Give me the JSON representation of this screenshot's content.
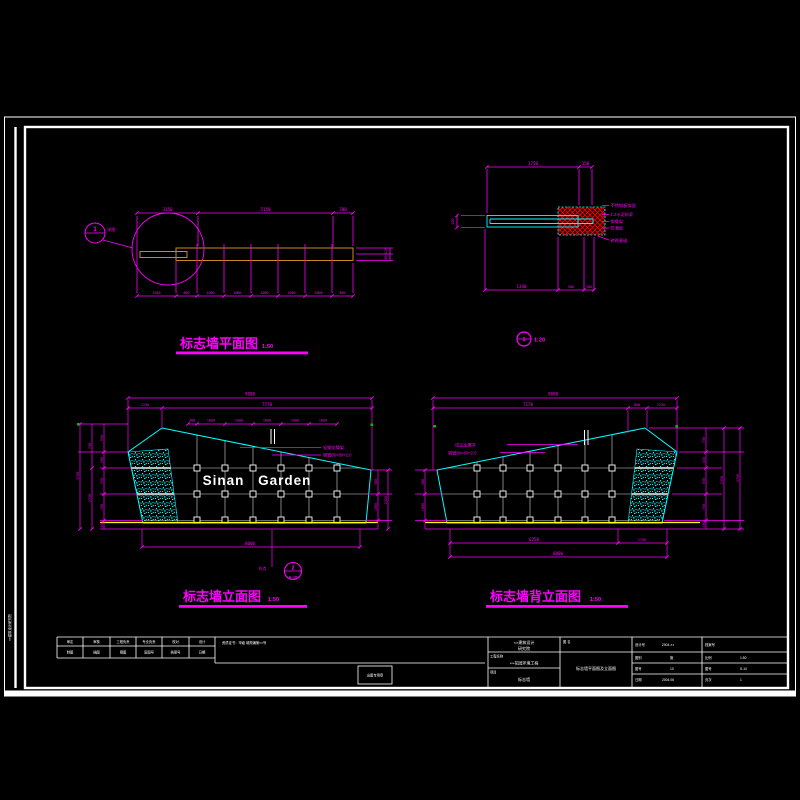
{
  "margin": {
    "vertical_text": "××建筑设计研究院"
  },
  "plan": {
    "title": "标志墙平面图",
    "scale": "1:50",
    "callout_num": "1",
    "callout_label": "详图",
    "dims_top": [
      "3150",
      "5150",
      "700"
    ],
    "dims_bottom": [
      "1340",
      "800",
      "1000",
      "1000",
      "1000",
      "1000",
      "1000",
      "800"
    ],
    "dims_right": [
      "120",
      "80"
    ]
  },
  "detail": {
    "num": "1",
    "scale": "1:20",
    "dim_left": "200",
    "dims_top": [
      "1750",
      "150"
    ],
    "dims_bottom": [
      "1340",
      "500",
      "300"
    ],
    "labels": [
      "不锈钢板饰面",
      "1:2水泥砂浆",
      "钢骨架",
      "防潮层",
      "砖砌基础"
    ]
  },
  "front": {
    "title": "标志墙立面图",
    "scale": "1:50",
    "sign": "Sinan Garden",
    "dim_overall_top": "9000",
    "dims_top2": [
      "1230",
      "7770"
    ],
    "dims_cols": [
      "300",
      "1000",
      "1000",
      "1000",
      "1000",
      "1000"
    ],
    "dims_left_inner": [
      "950",
      "580",
      "350",
      "700",
      "400"
    ],
    "dims_left_mid": [
      "730",
      "2330"
    ],
    "dim_left_outer": "3750",
    "dims_right_inner": [
      "580",
      "1000"
    ],
    "dim_right_outer": "2320",
    "dim_bottom": "8000",
    "ann1": "轻钢龙骨架",
    "ann2": "钢管80×80×2.0",
    "callout_num": "2",
    "callout_sheet": "A-10",
    "callout_label": "节点"
  },
  "back": {
    "title": "标志墙背立面图",
    "scale": "1:50",
    "dim_overall_top": "9000",
    "dims_top2": [
      "7170",
      "600",
      "1230"
    ],
    "dims_left_inner": [
      "580",
      "1000"
    ],
    "dims_right_inner": [
      "730",
      "445",
      "950",
      "750",
      "280"
    ],
    "dim_right_mid": "2350",
    "dim_right_outer": "3750",
    "dims_bottom": [
      "6250",
      "1750"
    ],
    "dim_bottom_overall": "8000",
    "ann1": "成品金属字",
    "ann2": "钢管80×80×2.0"
  },
  "titleblock": {
    "sig_row1": [
      "审定",
      "审核",
      "工程负责",
      "专业负责",
      "校对",
      "设计"
    ],
    "sig_row2": [
      "制图",
      "描图",
      "晒图",
      "底图号",
      "档案号",
      "日期"
    ],
    "cert": "资质证书：甲级 城规编第××号",
    "stamp": "出图专用章",
    "company1": "××建筑设计",
    "company2": "研究院",
    "project_label": "工程名称",
    "project": "××花园环境工程",
    "item_label": "项目",
    "item": "标志墙",
    "dwg_label": "图 名",
    "dwg": "标志墙平面图及立面图",
    "c3r1": "设计号",
    "c3r1v": "2004-××",
    "c3r2": "图别",
    "c3r2v": "施",
    "c3r3": "图号",
    "c3r3v": "10",
    "c3r4": "日期",
    "c3r4v": "2004.06",
    "c4r1": "档案号",
    "c4r2": "比例",
    "c4r2v": "1:50",
    "c4r3": "图号",
    "c4r3v": "S-10",
    "c4r4": "页次",
    "c4r4v": "1"
  }
}
